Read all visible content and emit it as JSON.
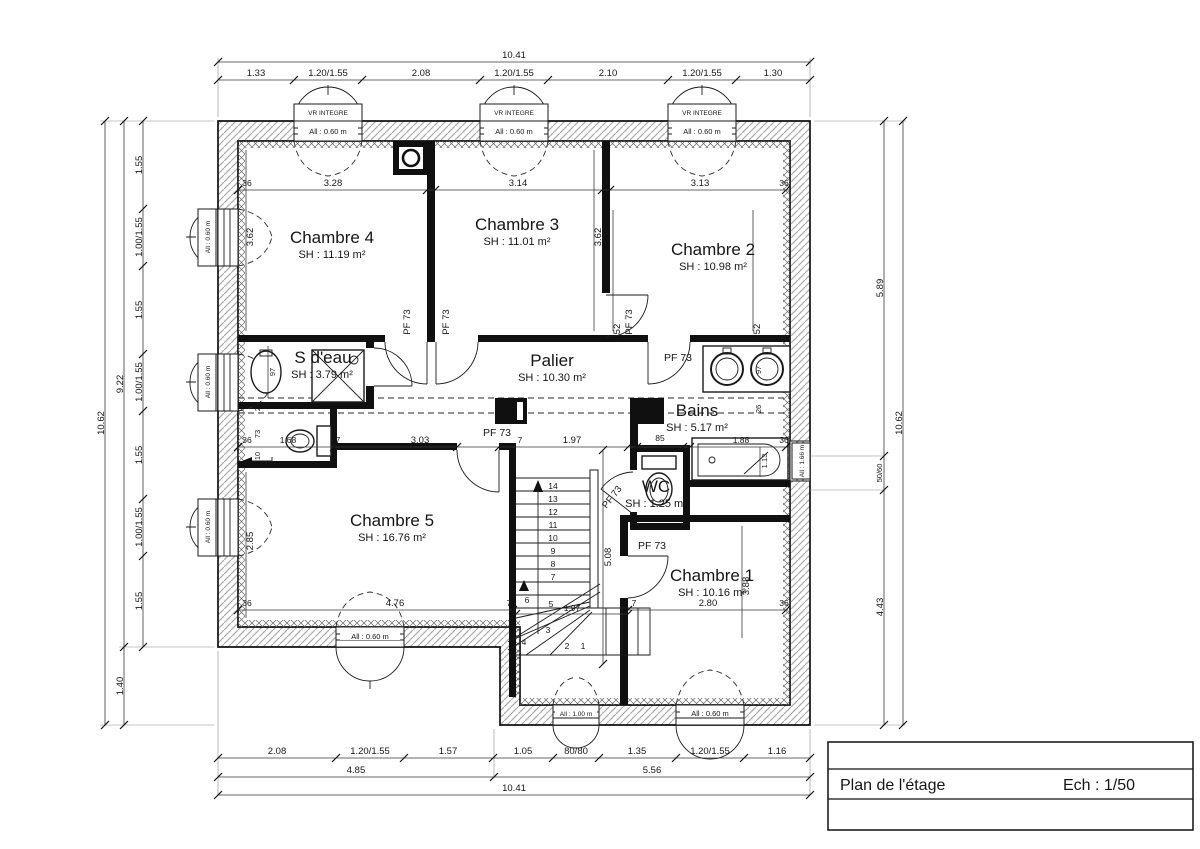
{
  "plan": {
    "title_block": {
      "title": "Plan de l'étage",
      "scale": "Ech : 1/50"
    },
    "rooms": {
      "c4": {
        "name": "Chambre 4",
        "area": "SH : 11.19 m²"
      },
      "c3": {
        "name": "Chambre 3",
        "area": "SH : 11.01 m²"
      },
      "c2": {
        "name": "Chambre 2",
        "area": "SH : 10.98 m²"
      },
      "sdeau": {
        "name": "S d'eau",
        "area": "SH : 3.79 m²"
      },
      "palier": {
        "name": "Palier",
        "area": "SH : 10.30 m²"
      },
      "bains": {
        "name": "Bains",
        "area": "SH : 5.17 m²"
      },
      "wc": {
        "name": "WC",
        "area": "SH : 1.25 m²"
      },
      "c5": {
        "name": "Chambre 5",
        "area": "SH : 16.76 m²"
      },
      "c1": {
        "name": "Chambre 1",
        "area": "SH : 10.16 m²"
      }
    },
    "door_label": "PF 73",
    "window_labels": {
      "vr": "VR INTEGRE",
      "a060": "All : 0.60 m",
      "a100": "All : 1.00 m",
      "a166": "All : 1.66 m"
    },
    "stairs": {
      "steps": [
        "1",
        "2",
        "3",
        "4",
        "5",
        "6",
        "7",
        "8",
        "9",
        "10",
        "11",
        "12",
        "13",
        "14"
      ]
    },
    "dims": {
      "top": {
        "total": "10.41",
        "segments": [
          "1.33",
          "1.20/1.55",
          "2.08",
          "1.20/1.55",
          "2.10",
          "1.20/1.55",
          "1.30"
        ]
      },
      "bottom": {
        "total": "10.41",
        "subtotals": [
          "4.85",
          "5.56"
        ],
        "segments": [
          "2.08",
          "1.20/1.55",
          "1.57",
          "1.05",
          "80/80",
          "1.35",
          "1.20/1.55",
          "1.16"
        ]
      },
      "left": {
        "total": "10.62",
        "subtotals": [
          "9.22",
          "1.40"
        ],
        "segments": [
          "1.55",
          "1.00/1.55",
          "1.55",
          "1.00/1.55",
          "1.55",
          "1.00/1.55",
          "1.55"
        ]
      },
      "right": {
        "total": "10.62",
        "segments": [
          "5.89",
          "50/60",
          "4.43"
        ]
      },
      "interior": {
        "c4_width": "3.28",
        "c3_width": "3.14",
        "c2_width": "3.13",
        "c4_depth": "3.62",
        "c3_depth": "3.62",
        "c2_depth": "3.52",
        "nook_width": "1.68",
        "hall_width": "3.03",
        "palier_width": "1.97",
        "wc_width": "85",
        "bath_width": "1.88",
        "bath_depth": "1.13",
        "c5_width": "4.76",
        "c5_depth": "2.85",
        "c1_width": "2.80",
        "c1_depth": "3.88",
        "stair_run": "5.08",
        "stair_width": "1.97",
        "wall36": "36",
        "wall7": "7",
        "n97": "97",
        "n26": "26",
        "n73": "73",
        "n10": "10"
      }
    }
  }
}
